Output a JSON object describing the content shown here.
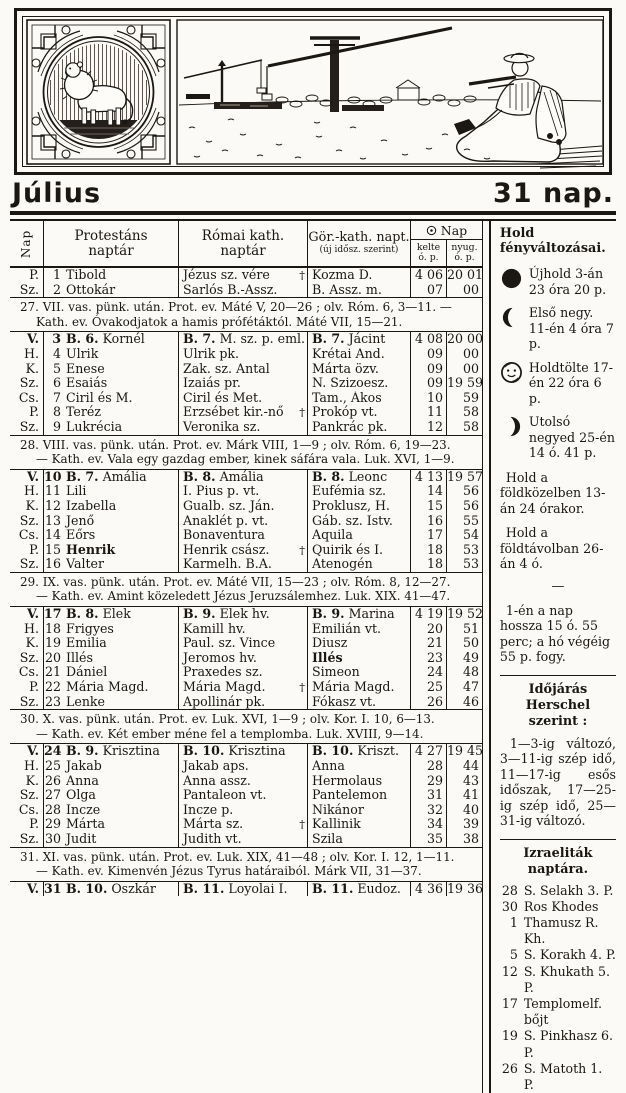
{
  "page": {
    "month": "Július",
    "days_label": "31 nap."
  },
  "illustration": {
    "left_panel": "leo-lion-medallion",
    "right_panel": "pastoral-shepherd-scene"
  },
  "table_header": {
    "day_col": "Nap",
    "protestant_1": "Protestáns",
    "protestant_2": "naptár",
    "roman_1": "Római kath.",
    "roman_2": "naptár",
    "greek": "Gör.-kath. napt.",
    "greek_sub": "(új idősz. szerint)",
    "sun_label": "Nap",
    "rise_1": "kelte",
    "rise_2": "ó. p.",
    "set_1": "nyug.",
    "set_2": "ó. p."
  },
  "calendar": {
    "blocks": [
      {
        "rows": [
          {
            "w": "P.",
            "n": "1",
            "pt": "Tibold",
            "rt": "Jézus sz. vére",
            "cross": true,
            "gt": "Kozma D.",
            "rise": "4 06",
            "set": "20 01"
          },
          {
            "w": "Sz.",
            "n": "2",
            "pt": "Ottokár",
            "rt": "Sarlós B.-Assz.",
            "gt": "B. Assz. m.",
            "rise": "07",
            "set": "00"
          }
        ]
      },
      {
        "note1": "27. VII. vas. pünk. után. Prot. ev. Máté V, 20—26 ; olv. Róm. 6, 3—11. —",
        "note2": "Kath. ev. Óvakodjatok a hamis prófétáktól. Máté VII, 15—21.",
        "rows": [
          {
            "w": "V.",
            "sun": true,
            "n": "3",
            "pb": "B. 6.",
            "pt": "Kornél",
            "rb": "B. 7.",
            "rt": "M. sz. p. eml.",
            "gb": "B. 7.",
            "gt": "Jácint",
            "rise": "4 08",
            "set": "20 00"
          },
          {
            "w": "H.",
            "n": "4",
            "pt": "Ulrik",
            "rt": "Ulrik pk.",
            "gt": "Krétai And.",
            "rise": "09",
            "set": "00"
          },
          {
            "w": "K.",
            "n": "5",
            "pt": "Enese",
            "rt": "Zak. sz. Antal",
            "gt": "Márta özv.",
            "rise": "09",
            "set": "00"
          },
          {
            "w": "Sz.",
            "n": "6",
            "pt": "Esaiás",
            "rt": "Izaiás pr.",
            "gt": "N. Szizoesz.",
            "rise": "09",
            "set": "19 59"
          },
          {
            "w": "Cs.",
            "n": "7",
            "pt": "Ciril és M.",
            "rt": "Ciril és Met.",
            "gt": "Tam., Ákos",
            "rise": "10",
            "set": "59"
          },
          {
            "w": "P.",
            "n": "8",
            "pt": "Teréz",
            "rt": "Erzsébet kir.-nő",
            "cross": true,
            "gt": "Prokóp vt.",
            "rise": "11",
            "set": "58"
          },
          {
            "w": "Sz.",
            "n": "9",
            "pt": "Lukrécia",
            "rt": "Veronika sz.",
            "gt": "Pankrác pk.",
            "rise": "12",
            "set": "58"
          }
        ]
      },
      {
        "note1": "28. VIII. vas. pünk. után. Prot. ev. Márk VIII, 1—9 ; olv. Róm. 6, 19—23.",
        "note2": "— Kath. ev. Vala egy gazdag ember, kinek sáfára vala. Luk. XVI, 1—9.",
        "rows": [
          {
            "w": "V.",
            "sun": true,
            "n": "10",
            "pb": "B. 7.",
            "pt": "Amália",
            "rb": "B. 8.",
            "rt": "Amália",
            "gb": "B. 8.",
            "gt": "Leonc",
            "rise": "4 13",
            "set": "19 57"
          },
          {
            "w": "H.",
            "n": "11",
            "pt": "Lili",
            "rt": "I. Pius p. vt.",
            "gt": "Eufémia sz.",
            "rise": "14",
            "set": "56"
          },
          {
            "w": "K.",
            "n": "12",
            "pt": "Izabella",
            "rt": "Gualb. sz. Ján.",
            "gt": "Proklusz, H.",
            "rise": "15",
            "set": "56"
          },
          {
            "w": "Sz.",
            "n": "13",
            "pt": "Jenő",
            "rt": "Anaklét p. vt.",
            "gt": "Gáb. sz. Istv.",
            "rise": "16",
            "set": "55"
          },
          {
            "w": "Cs.",
            "n": "14",
            "pt": "Eőrs",
            "rt": "Bonaventura",
            "gt": "Aquila",
            "rise": "17",
            "set": "54"
          },
          {
            "w": "P.",
            "n": "15",
            "pb": "Henrik",
            "rt": "Henrik csász.",
            "cross": true,
            "gt": "Quirik és I.",
            "rise": "18",
            "set": "53"
          },
          {
            "w": "Sz.",
            "n": "16",
            "pt": "Valter",
            "rt": "Karmelh. B.A.",
            "gt": "Atenogén",
            "rise": "18",
            "set": "53"
          }
        ]
      },
      {
        "note1": "29. IX. vas. pünk. után. Prot. ev. Máté VII, 15—23 ; olv. Róm. 8, 12—27.",
        "note2": "— Kath. ev. Amint közeledett Jézus Jeruzsálemhez. Luk. XIX. 41—47.",
        "rows": [
          {
            "w": "V.",
            "sun": true,
            "n": "17",
            "pb": "B. 8.",
            "pt": "Elek",
            "rb": "B. 9.",
            "rt": "Elek hv.",
            "gb": "B. 9.",
            "gt": "Marina",
            "rise": "4 19",
            "set": "19 52"
          },
          {
            "w": "H.",
            "n": "18",
            "pt": "Frigyes",
            "rt": "Kamill hv.",
            "gt": "Emilián vt.",
            "rise": "20",
            "set": "51"
          },
          {
            "w": "K.",
            "n": "19",
            "pt": "Emilia",
            "rt": "Paul. sz. Vince",
            "gt": "Diusz",
            "rise": "21",
            "set": "50"
          },
          {
            "w": "Sz.",
            "n": "20",
            "pt": "Illés",
            "rt": "Jeromos hv.",
            "gb": "Illés",
            "rise": "23",
            "set": "49"
          },
          {
            "w": "Cs.",
            "n": "21",
            "pt": "Dániel",
            "rt": "Praxedes sz.",
            "gt": "Simeon",
            "rise": "24",
            "set": "48"
          },
          {
            "w": "P.",
            "n": "22",
            "pt": "Mária Magd.",
            "rt": "Mária Magd.",
            "cross": true,
            "gt": "Mária Magd.",
            "rise": "25",
            "set": "47"
          },
          {
            "w": "Sz.",
            "n": "23",
            "pt": "Lenke",
            "rt": "Apollinár pk.",
            "gt": "Fókasz vt.",
            "rise": "26",
            "set": "46"
          }
        ]
      },
      {
        "note1": "30. X. vas. pünk. után. Prot. ev. Luk. XVI, 1—9 ; olv. Kor. I. 10, 6—13.",
        "note2": "— Kath. ev. Két ember méne fel a templomba. Luk. XVIII, 9—14.",
        "rows": [
          {
            "w": "V.",
            "sun": true,
            "n": "24",
            "pb": "B. 9.",
            "pt": "Krisztina",
            "rb": "B. 10.",
            "rt": "Krisztina",
            "gb": "B. 10.",
            "gt": "Kriszt.",
            "rise": "4 27",
            "set": "19 45"
          },
          {
            "w": "H.",
            "n": "25",
            "pt": "Jakab",
            "rt": "Jakab aps.",
            "gt": "Anna",
            "rise": "28",
            "set": "44"
          },
          {
            "w": "K.",
            "n": "26",
            "pt": "Anna",
            "rt": "Anna assz.",
            "gt": "Hermolaus",
            "rise": "29",
            "set": "43"
          },
          {
            "w": "Sz.",
            "n": "27",
            "pt": "Olga",
            "rt": "Pantaleon vt.",
            "gt": "Pantelemon",
            "rise": "31",
            "set": "41"
          },
          {
            "w": "Cs.",
            "n": "28",
            "pt": "Incze",
            "rt": "Incze p.",
            "gt": "Nikánor",
            "rise": "32",
            "set": "40"
          },
          {
            "w": "P.",
            "n": "29",
            "pt": "Márta",
            "rt": "Márta sz.",
            "cross": true,
            "gt": "Kallinik",
            "rise": "34",
            "set": "39"
          },
          {
            "w": "Sz.",
            "n": "30",
            "pt": "Judit",
            "rt": "Judith vt.",
            "gt": "Szila",
            "rise": "35",
            "set": "38"
          }
        ]
      },
      {
        "note1": "31. XI. vas. pünk. után. Prot. ev. Luk. XIX, 41—48 ; olv. Kor. I. 12, 1—11.",
        "note2": "— Kath. ev. Kimenvén Jézus Tyrus határaiból. Márk VII, 31—37.",
        "rows": [
          {
            "w": "V.",
            "sun": true,
            "n": "31",
            "pb": "B. 10.",
            "pt": "Oszkár",
            "rb": "B. 11.",
            "rt": "Loyolai I.",
            "gb": "B. 11.",
            "gt": "Eudoz.",
            "rise": "4 36",
            "set": "19 36"
          }
        ]
      }
    ]
  },
  "sidebar": {
    "moon_title": "Hold fényváltozásai.",
    "phases": [
      {
        "icon": "new-moon-icon",
        "text": "Újhold 3-án 23 óra 20 p."
      },
      {
        "icon": "first-quarter-icon",
        "text": "Első negy. 11-én 4 óra 7 p."
      },
      {
        "icon": "full-moon-icon",
        "text": "Holdtölte 17-én 22 óra 6 p."
      },
      {
        "icon": "last-quarter-icon",
        "text": "Utolsó negyed 25-én 14 ó. 41 p."
      }
    ],
    "perigee": "Hold a földközelben 13-án 24 órakor.",
    "apogee": "Hold a földtávolban 26-án 4 ó.",
    "dash": "—",
    "day_length": "1-én a nap hossza 15 ó. 55 perc; a hó végéig 55 p. fogy.",
    "weather_title": "Időjárás Herschel szerint :",
    "weather_text": "1—3-ig változó, 3—11-ig szép idő, 11—17-ig esős időszak, 17—25-ig szép idő, 25—31-ig változó.",
    "israelite_title": "Izraeliták naptára.",
    "israelite_items": [
      {
        "n": "28",
        "t": "S. Selakh 3. P."
      },
      {
        "n": "30",
        "t": "Ros Khodes"
      },
      {
        "n": "1",
        "t": "Thamusz R. Kh."
      },
      {
        "n": "5",
        "t": "S. Korakh 4. P."
      },
      {
        "n": "12",
        "t": "S. Khukath 5. P."
      },
      {
        "n": "17",
        "t": "Templomelf. bőjt"
      },
      {
        "n": "19",
        "t": "S. Pinkhasz 6. P."
      },
      {
        "n": "26",
        "t": "S. Matoth 1. P."
      }
    ]
  }
}
